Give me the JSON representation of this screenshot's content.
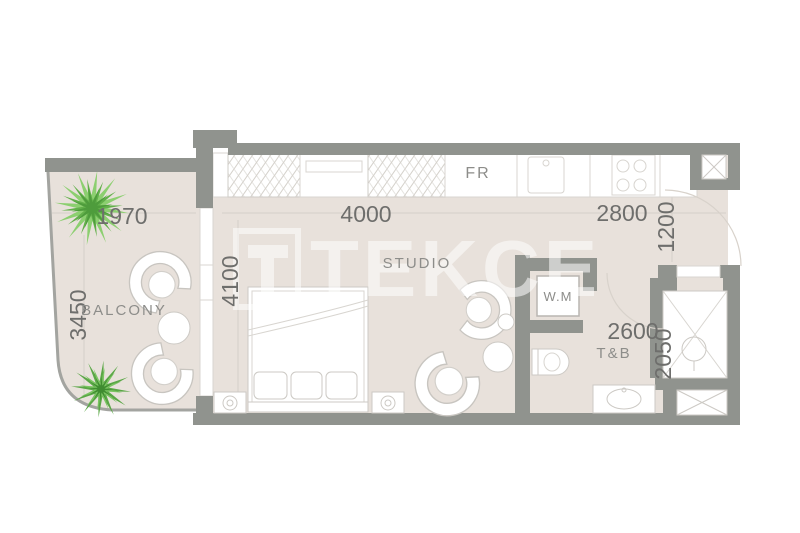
{
  "plan": {
    "watermark": {
      "logo_letter": "T",
      "brand": "TEKCE"
    },
    "rooms": {
      "balcony": "BALCONY",
      "studio": "STUDIO",
      "bath": "T&B",
      "washing_machine": "W.M",
      "fridge": "FR"
    },
    "dimensions": {
      "balcony_width": "1970",
      "balcony_depth": "3450",
      "studio_depth": "4100",
      "studio_width": "4000",
      "kitchen_width": "2800",
      "entry_depth": "1200",
      "bath_width": "2600",
      "bath_depth": "2050"
    },
    "colors": {
      "wall": "#90938e",
      "floor": "#e8e1db",
      "furniture_outline": "#ccc9c4",
      "dimension_text": "#6e6e6c",
      "room_text": "#8d8d8a",
      "plant_green": "#62b04a",
      "watermark": "#ffffff"
    }
  }
}
